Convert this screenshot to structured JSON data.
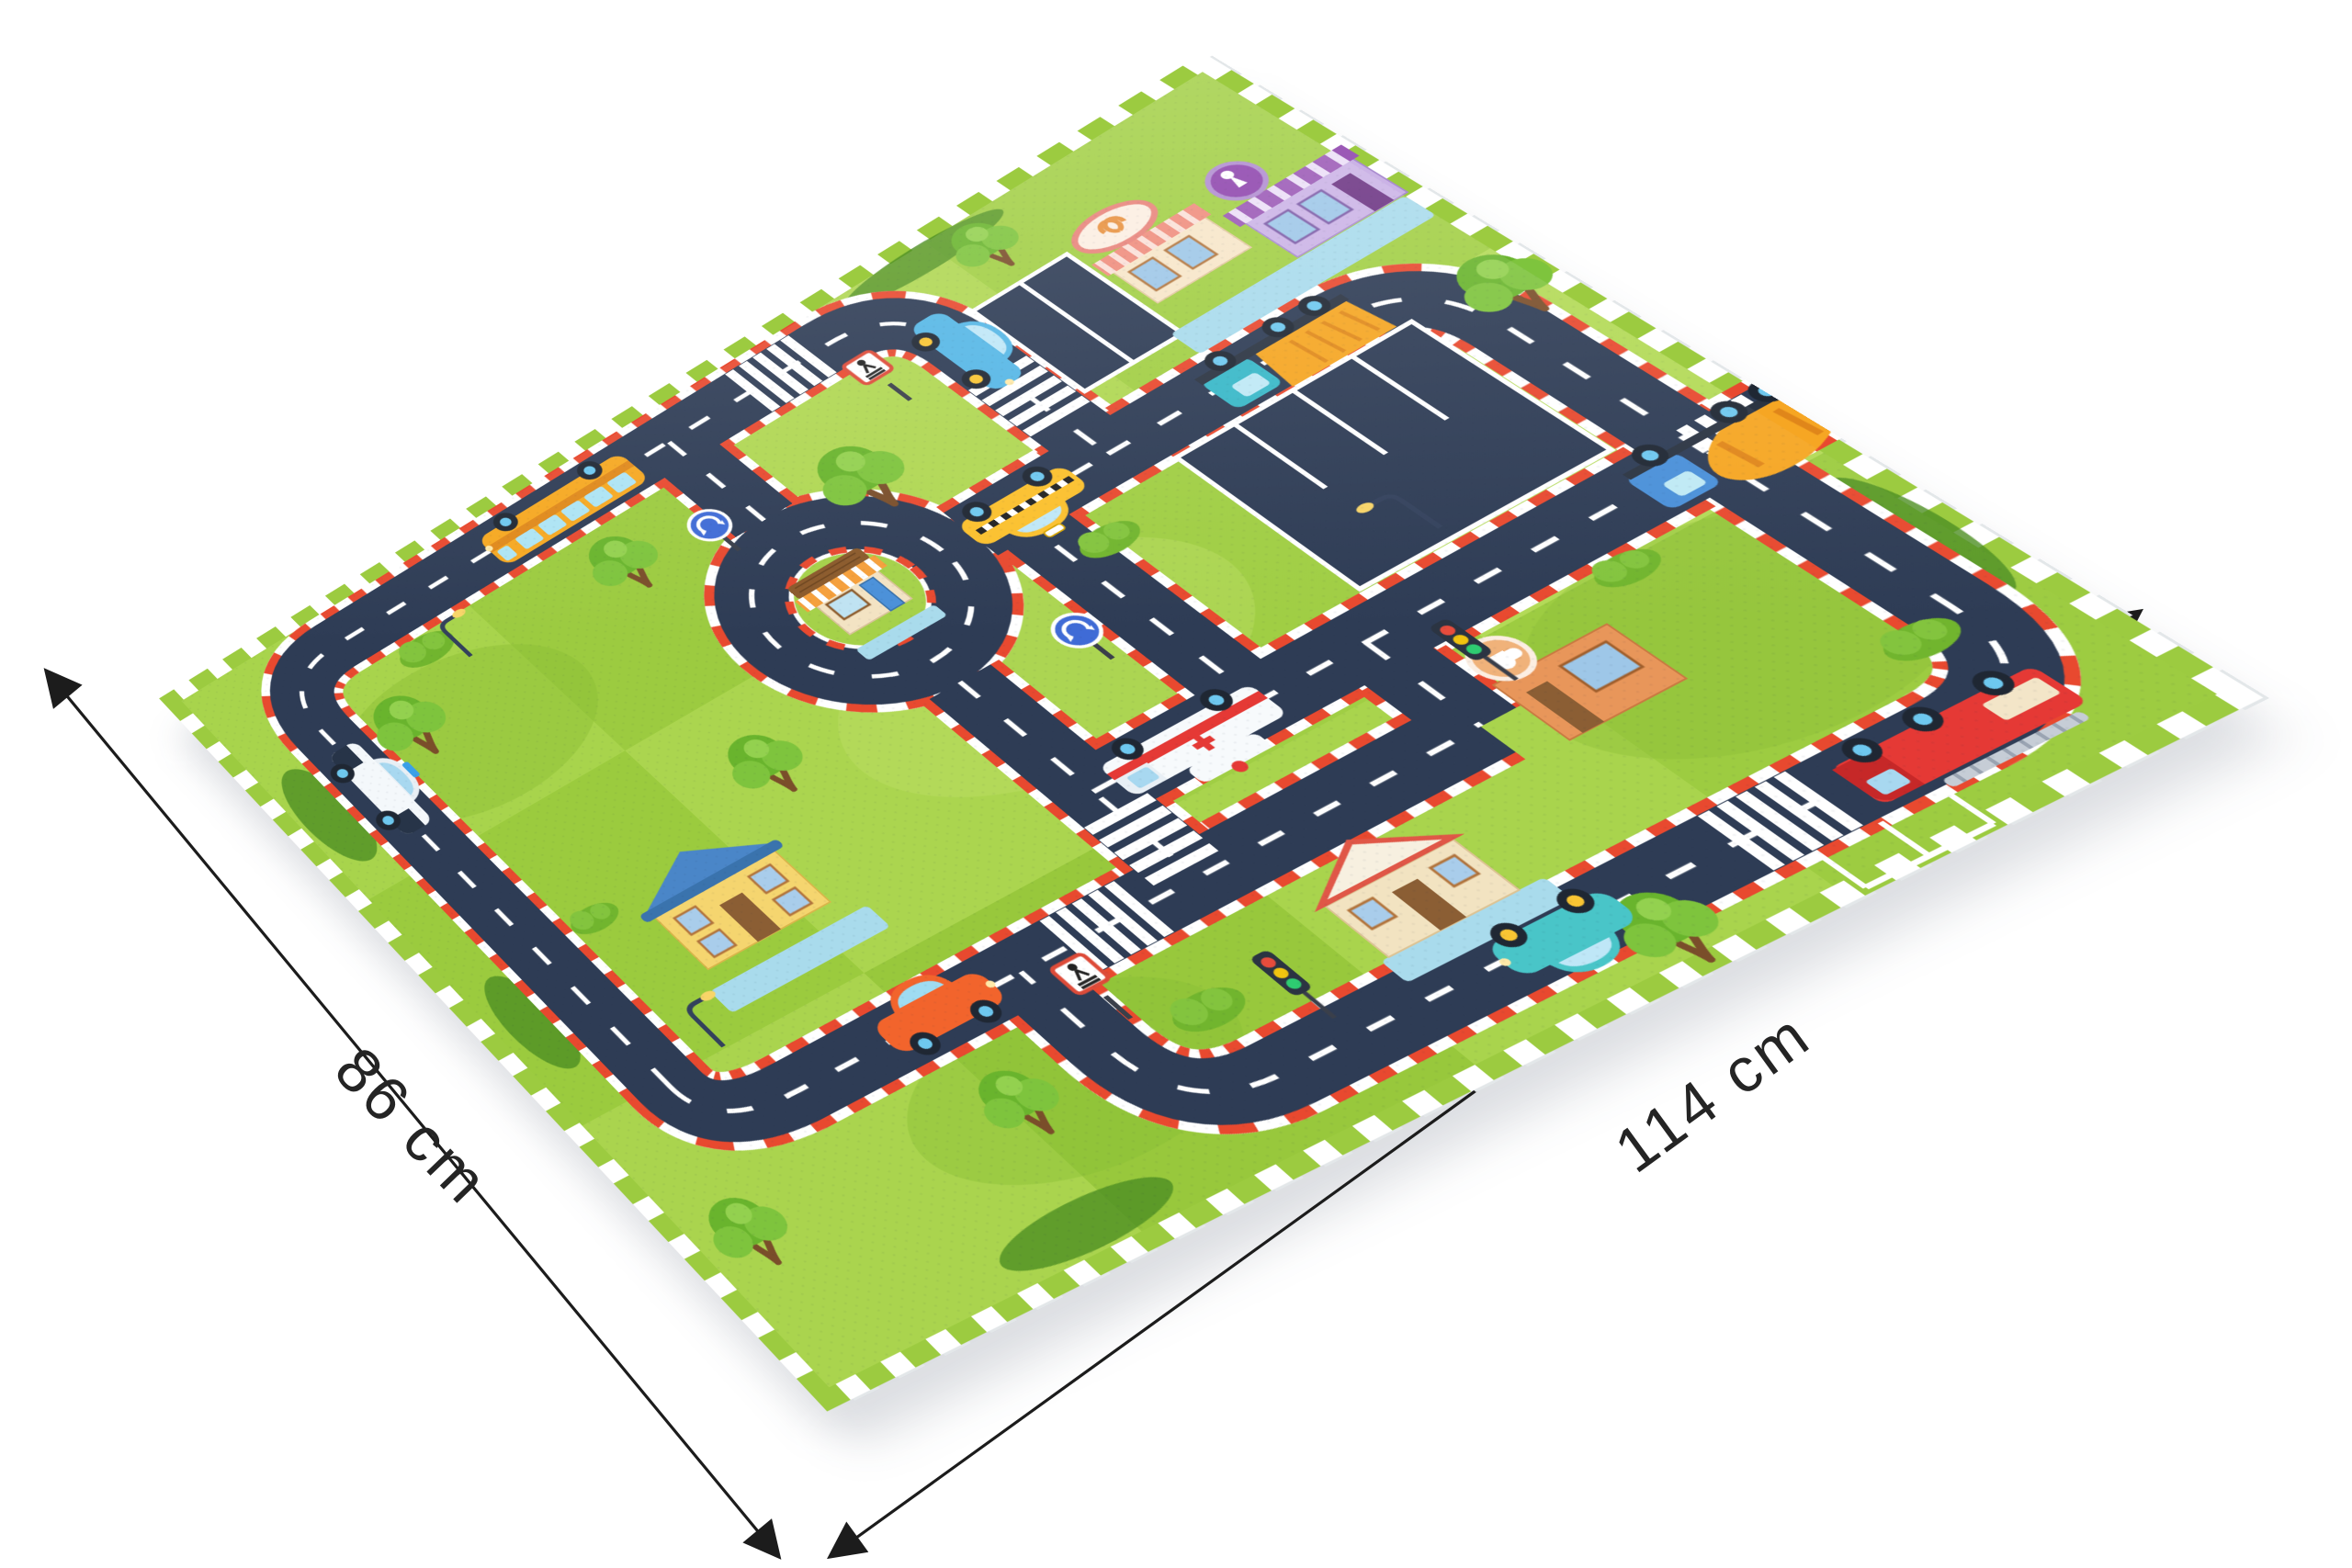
{
  "product_photo": {
    "background_color": "#ffffff",
    "dimension_labels": {
      "left": "86 cm",
      "right": "114 cm"
    },
    "mat": {
      "palette": {
        "grass": "#a3d148",
        "grass_dark": "#74b42e",
        "road": "#2e3c55",
        "road_dash": "#ffffff",
        "curb_red": "#e8492f",
        "sidewalk_blue": "#aadcec",
        "foam_edge_white": "#ffffff"
      },
      "vehicles": [
        "school-bus",
        "blue-car",
        "police-car",
        "taxi",
        "ambulance",
        "dump-truck",
        "cement-mixer",
        "fire-truck",
        "teal-car",
        "orange-car"
      ],
      "buildings": [
        "bakery",
        "ice-cream-shop",
        "roundabout-shop",
        "school-house",
        "red-roof-house",
        "coffee-shop"
      ],
      "road_features": [
        "roundabout",
        "crosswalks",
        "parking-lot",
        "roundabout-signs",
        "pedestrian-signs",
        "traffic-lights",
        "street-lamps",
        "trees",
        "bushes"
      ]
    }
  }
}
